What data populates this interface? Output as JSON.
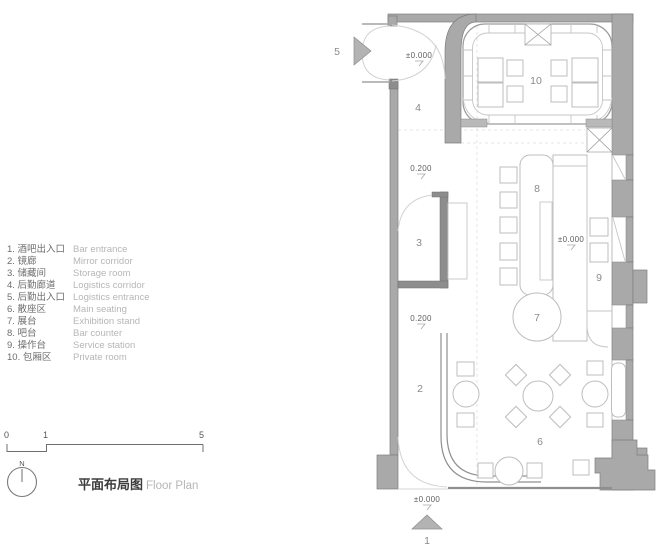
{
  "title": {
    "zh": "平面布局图",
    "en": "Floor Plan"
  },
  "north": {
    "label": "N",
    "icon": "north-compass-icon"
  },
  "scale_bar": {
    "labels": [
      "0",
      "1",
      "5"
    ]
  },
  "legend": {
    "items": [
      {
        "zh": "1. 酒吧出入口",
        "en": "Bar entrance"
      },
      {
        "zh": "2. 镜廊",
        "en": "Mirror corridor"
      },
      {
        "zh": "3. 储藏间",
        "en": "Storage room"
      },
      {
        "zh": "4. 后勤廊道",
        "en": "Logistics corridor"
      },
      {
        "zh": "5. 后勤出入口",
        "en": "Logistics entrance"
      },
      {
        "zh": "6. 散座区",
        "en": "Main seating"
      },
      {
        "zh": "7. 展台",
        "en": "Exhibition stand"
      },
      {
        "zh": "8. 吧台",
        "en": "Bar counter"
      },
      {
        "zh": "9. 操作台",
        "en": "Service station"
      },
      {
        "zh": "10. 包厢区",
        "en": "Private room"
      }
    ]
  },
  "plan": {
    "room_labels": {
      "n2": "2",
      "n3": "3",
      "n4": "4",
      "n6": "6",
      "n7": "7",
      "n8": "8",
      "n9": "9",
      "n10": "10"
    },
    "entrances": {
      "side_label": "5",
      "main_label": "1"
    },
    "level_markers": [
      "±0.000",
      "0.200",
      "±0.000",
      "0.200",
      "±0.000"
    ]
  },
  "colors": {
    "wall_gray": "#a9a9a9",
    "thin_wall_gray": "#8d8d8d",
    "furniture_line": "#bdbdbd",
    "room_label_text": "#8a8a8a",
    "legend_zh_text": "#6e6e6e",
    "legend_en_text": "#b6b6b6",
    "title_text": "#3d3d3d"
  }
}
